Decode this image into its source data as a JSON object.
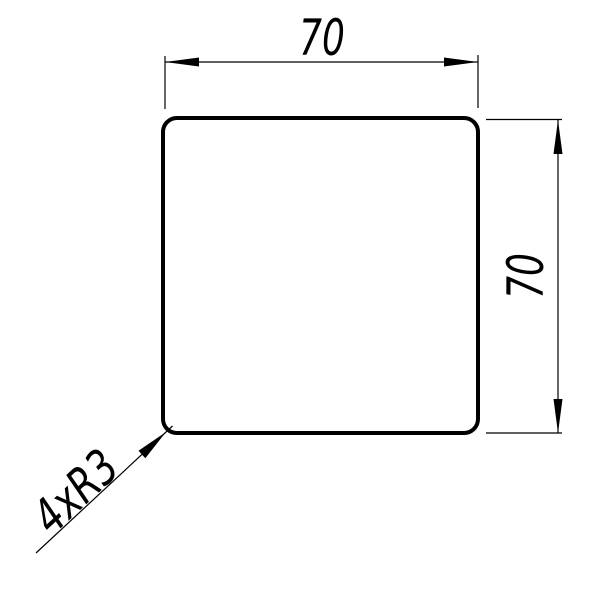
{
  "drawing": {
    "colors": {
      "line": "#000000",
      "background": "#ffffff",
      "part_fill": "#ffffff"
    },
    "dimensions": {
      "width": {
        "value": "70"
      },
      "height": {
        "value": "70"
      }
    },
    "leader_note": {
      "value": "4xR3"
    }
  }
}
